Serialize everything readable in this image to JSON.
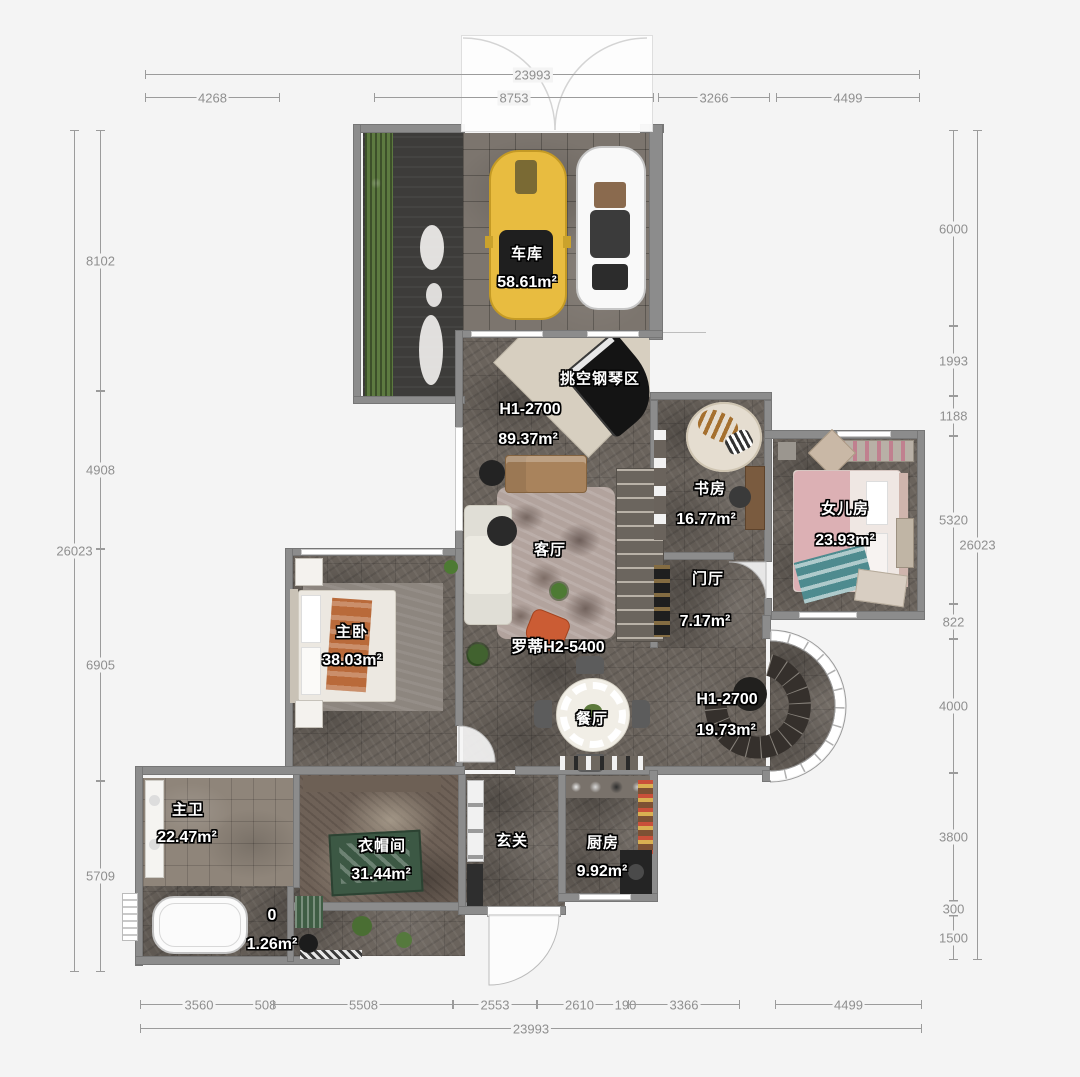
{
  "dims": {
    "top_total": "23993",
    "bottom_total": "23993",
    "left_total": "26023",
    "right_total": "26023",
    "top": [
      "4268",
      "8753",
      "3266",
      "4499"
    ],
    "left": [
      "8102",
      "4908",
      "6905",
      "5709"
    ],
    "right": [
      "6000",
      "1993",
      "1188",
      "5320",
      "822",
      "4000",
      "3800",
      "300",
      "1500"
    ],
    "bottom": [
      "3560",
      "508",
      "5508",
      "2553",
      "2610",
      "190",
      "3366",
      "4499"
    ]
  },
  "rooms": {
    "garage": {
      "name": "车库",
      "area": "58.61m²"
    },
    "piano": {
      "name": "挑空钢琴区"
    },
    "living": {
      "code": "H1-2700",
      "area": "89.37m²",
      "name": "客厅"
    },
    "study": {
      "name": "书房",
      "area": "16.77m²"
    },
    "daughter": {
      "name": "女儿房",
      "area": "23.93m²"
    },
    "foyer": {
      "name": "门厅",
      "area": "7.17m²"
    },
    "sofa_model": {
      "name": "罗蒂H2-5400"
    },
    "dining": {
      "name": "餐厅",
      "code": "H1-2700",
      "area": "19.73m²"
    },
    "master": {
      "name": "主卧",
      "area": "38.03m²"
    },
    "master_bath": {
      "name": "主卫",
      "area": "22.47m²"
    },
    "cloak": {
      "name": "衣帽间",
      "area": "31.44m²"
    },
    "closet": {
      "name": "0",
      "area": "1.26m²"
    },
    "entry": {
      "name": "玄关"
    },
    "kitchen": {
      "name": "厨房",
      "area": "9.92m²"
    }
  },
  "colors": {
    "background": "#f4f4f4",
    "wall": "#8c8c8c",
    "floor_dark": "#6a635c",
    "dim_text": "#8f8f8f",
    "accent_car": "#e8bc40",
    "hedge": "#5d7a40"
  }
}
